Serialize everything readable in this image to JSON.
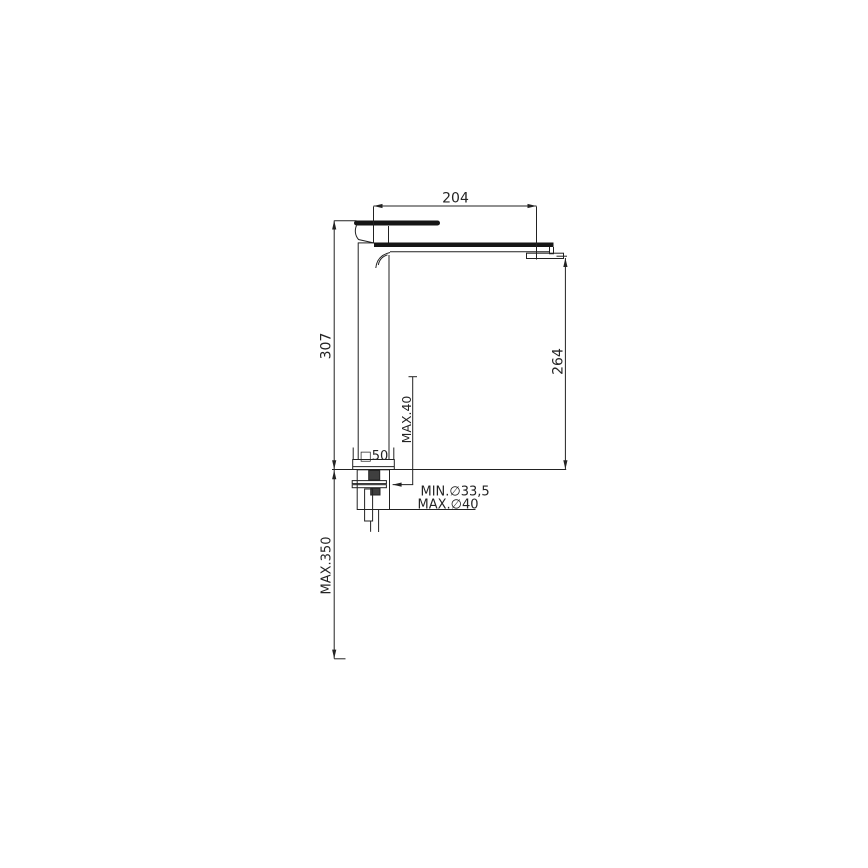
{
  "page": {
    "background_color": "#ffffff",
    "line_color": "#222222"
  },
  "drawing": {
    "kind": "faucet-installation-dimension-drawing",
    "labels": {
      "spout_reach": "204",
      "total_height": "307",
      "outlet_height": "264",
      "max_deck_thickness": "MAX.40",
      "base_square": "□50",
      "min_hole_diameter": "MIN.∅33,5",
      "max_hole_diameter": "MAX.∅40",
      "max_below_deck": "MAX.350"
    }
  }
}
